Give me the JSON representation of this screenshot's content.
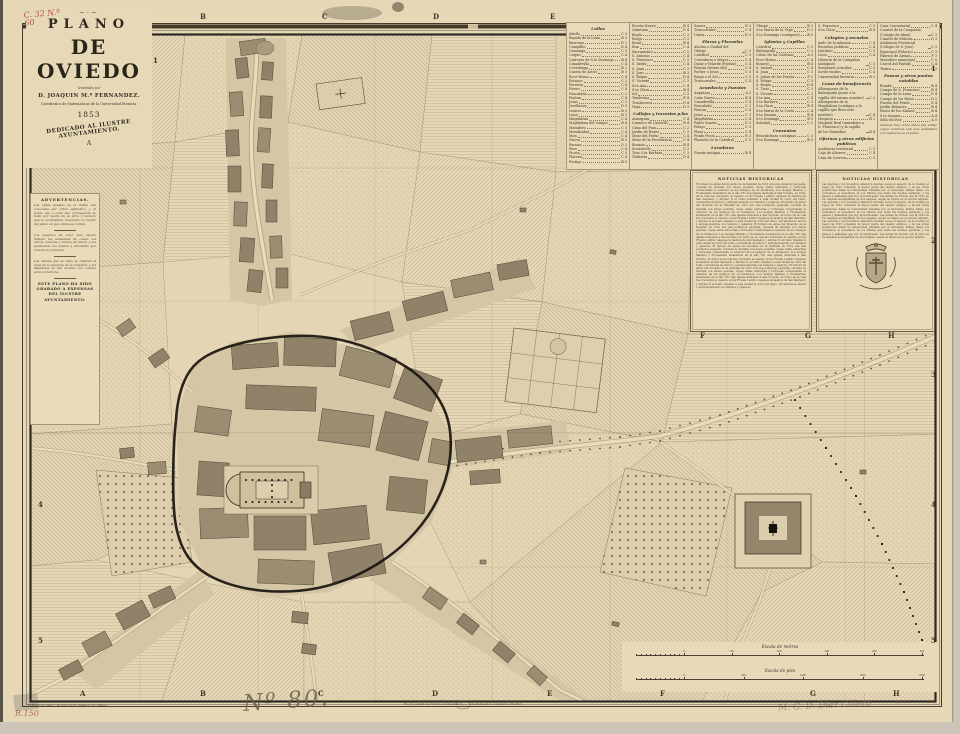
{
  "sheet": {
    "title_block": {
      "flourish": "~·~",
      "kicker": "PLANO",
      "title": "DE OVIEDO",
      "byline_small": "levantado por",
      "author": "D. JOAQUIN M.ª FERNANDEZ.",
      "author_role": "Catedratico de Matematicas de la Universidad literaria.",
      "year": "1853",
      "dedication": "DEDICADO AL ILUSTRE AYUNTAMIENTO.",
      "corner_mark": "A",
      "shelf_mark": "C. 32  N.º 60"
    },
    "grid": {
      "top_letters": [
        "B",
        "C",
        "D",
        "E"
      ],
      "mid_letters": [
        "F",
        "G",
        "H"
      ],
      "bottom_letters": [
        "A",
        "B",
        "C",
        "D",
        "E",
        "F",
        "G",
        "H"
      ],
      "left_numbers": [
        "1",
        "4",
        "5"
      ],
      "right_numbers": [
        "1",
        "2",
        "3",
        "4",
        "5"
      ]
    },
    "index": {
      "columns": [
        [
          {
            "h": "Calles"
          },
          [
            "Abello",
            "C 3"
          ],
          [
            "Bajada de la Luna",
            "B 3"
          ],
          [
            "Barreras",
            "D 2"
          ],
          [
            "Campillin",
            "D 4"
          ],
          [
            "Canoniga",
            "C 3"
          ],
          [
            "Carpio",
            "C 4"
          ],
          [
            "Carreras de S.to Domingo",
            "B 4"
          ],
          [
            "Cimadevilla",
            "C 4"
          ],
          [
            "Covadonga",
            "B 2"
          ],
          [
            "Cuesta de Arcos",
            "B 3"
          ],
          [
            "Ecce-Homo",
            "C 4"
          ],
          [
            "Estanco",
            "C 2"
          ],
          [
            "Ferreria",
            "C 4"
          ],
          [
            "Fierro",
            "C 4"
          ],
          [
            "Foncalada",
            "C 2"
          ],
          [
            "Fontan",
            "C 4"
          ],
          [
            "Jesus",
            "C 3"
          ],
          [
            "Jovellanos",
            "D 3"
          ],
          [
            "Leones",
            "B 3"
          ],
          [
            "Luna",
            "B 3"
          ],
          [
            "Magdalena",
            "C 4"
          ],
          [
            "Magdalena del Campo",
            "B 4"
          ],
          [
            "Matadero",
            "C 5"
          ],
          [
            "Mendizabal",
            "C 4"
          ],
          [
            "Mon",
            "C 4"
          ],
          [
            "Nueva",
            "B 3"
          ],
          [
            "Paraiso",
            "D 3"
          ],
          [
            "Peso",
            "C 4"
          ],
          [
            "Picota",
            "C 5"
          ],
          [
            "Plateria",
            "C 4"
          ],
          [
            "Postigo",
            "B 5"
          ]
        ],
        [
          [
            "Puerta Nueva",
            "B 4"
          ],
          [
            "Quintana",
            "D 4"
          ],
          [
            "Regla",
            "C 3"
          ],
          [
            "Riego",
            "C 3"
          ],
          [
            "Rosal",
            "B 4"
          ],
          [
            "Rua",
            "C 4"
          ],
          [
            "Sacramento",
            "C 5"
          ],
          [
            "S. Antonio",
            "C 4"
          ],
          [
            "S. Francisco",
            "C 3"
          ],
          [
            "S. Isidro",
            "C 4"
          ],
          [
            "S. Juan",
            "C 3"
          ],
          [
            "S. Jose",
            "B 3"
          ],
          [
            "S. Roque",
            "D 4"
          ],
          [
            "S. Vicente",
            "C 3"
          ],
          [
            "S.ta Ana",
            "C 4"
          ],
          [
            "S.ta Clara",
            "B 4"
          ],
          [
            "Sol",
            "C 3"
          ],
          [
            "Tenderina",
            "E 4"
          ],
          [
            "Traslacerca",
            "D 4"
          ],
          [
            "Vega",
            "D 3"
          ],
          {
            "h": "Callejas y travesias p.les"
          },
          [
            "Amargura",
            "C 4"
          ],
          [
            "Canseco de Castiello",
            "B 4"
          ],
          [
            "Cima del Prau",
            "C 2"
          ],
          [
            "Jardin de Reyes",
            "C 3"
          ],
          [
            "Mear del Forno",
            "C 4"
          ],
          [
            "Mear de la Providencia",
            "C 4"
          ],
          [
            "Rosario",
            "B 4"
          ],
          [
            "Socastiello",
            "C 3"
          ],
          [
            "Tras S.ta Barbara",
            "C 3"
          ],
          [
            "Vidrieria",
            "D 4"
          ]
        ],
        [
          [
            "Sames",
            "E 3"
          ],
          [
            "Trascorrales",
            "C 4"
          ],
          [
            "Union",
            "D 3"
          ],
          {
            "h": "Plazas y Plazuelas"
          },
          [
            "Alcoba o Ciudad del Obispo",
            "C 3"
          ],
          [
            "Catedral",
            "C 3"
          ],
          [
            "Correduria o Mayor",
            "C 4"
          ],
          [
            "Daoiz y Velarde (Fontan)",
            "C 4"
          ],
          [
            "Fontan (detras del)",
            "C 4"
          ],
          [
            "Porlier o Jesus",
            "C 3"
          ],
          [
            "Riego o el Sol",
            "C 3"
          ],
          [
            "Trascorrales",
            "C 4"
          ],
          {
            "h": "Acueducto y Fuentes"
          },
          [
            "Argañosa",
            "A 3"
          ],
          [
            "Caño Nuevo",
            "B 4"
          ],
          [
            "Cimadevilla",
            "C 4"
          ],
          [
            "Foncalada",
            "C 2"
          ],
          [
            "Fontan",
            "C 4"
          ],
          [
            "Jesus",
            "C 3"
          ],
          [
            "Magdalena",
            "C 4"
          ],
          [
            "Padre Suarez",
            "D 3"
          ],
          [
            "Pelayo",
            "C 3"
          ],
          [
            "Plaza",
            "C 4"
          ],
          [
            "Prado Picon",
            "E 3"
          ],
          [
            "Plazuela de la Catedral",
            "C 3"
          ],
          {
            "h": "Lavaderos"
          },
          [
            "Fuente antigua",
            "B 4"
          ]
        ],
        [
          [
            "Obispo",
            "B 3"
          ],
          [
            "S.ta Maria de la Vega",
            "D 2"
          ],
          [
            "S.to Domingo (contiguos)",
            "B 5"
          ],
          {
            "h": "Iglesias y Capillas"
          },
          [
            "Catedral",
            "C 3"
          ],
          [
            "Balesquida",
            "C 3"
          ],
          [
            "Cristo de las Cadenas",
            "A 5"
          ],
          [
            "Ecce-Homo",
            "C 4"
          ],
          [
            "Rosario",
            "B 4"
          ],
          [
            "S. Isidoro",
            "C 4"
          ],
          [
            "S. Juan",
            "C 3"
          ],
          [
            "S. Julian de los Prados",
            "F 2"
          ],
          [
            "S. Pelayo",
            "C 3"
          ],
          [
            "S. Roque",
            "D 4"
          ],
          [
            "S. Tirso",
            "C 3"
          ],
          [
            "S. Vicente",
            "C 3"
          ],
          [
            "S.ta Ana",
            "C 4"
          ],
          [
            "S.ta Barbara",
            "C 3"
          ],
          [
            "S.ta Clara",
            "B 4"
          ],
          [
            "S.ta Maria de la Corte",
            "C 4"
          ],
          [
            "S.ta Susana",
            "B 4"
          ],
          [
            "S.to Domingo",
            "B 5"
          ],
          [
            "Soledad",
            "C 2"
          ],
          {
            "h": "Conventos"
          },
          [
            "Benedictinas contiguas",
            "C 3"
          ],
          [
            "S.to Domingo",
            "B 5"
          ]
        ],
        [
          [
            "S. Francisco",
            "C 3"
          ],
          [
            "S.ta Clara",
            "B 4"
          ],
          {
            "h": "Colegios y escuelas"
          },
          [
            "Asilo de la infancia",
            "C 4"
          ],
          [
            "Escuelas publicas",
            "C 4"
          ],
          [
            "Instituto",
            "C 3"
          ],
          [
            "Liceo",
            "C 4"
          ],
          [
            "Libreria de la Compañia (antiguos)",
            "C 3"
          ],
          [
            "Seminario conciliar",
            "C 3"
          ],
          [
            "Sordo-mudos",
            "C 4"
          ],
          [
            "Universidad literaria",
            "B 3"
          ],
          {
            "h": "Casas de beneficencia"
          },
          [
            "Albergueria de la Balesquida (junto a la capilla del mismo nombre)",
            "C 3"
          ],
          [
            "Albergueria de la Magdalena (contigua a la capilla que lleva este nombre)",
            "C 4"
          ],
          [
            "Hospicio",
            "B 2"
          ],
          [
            "Hospital Real (inmediato a S. Francisco) y la capilla de los Remedios",
            "B 4"
          ],
          {
            "h": "Oficinas y otros edificios publicos"
          },
          [
            "Audiencia territorial",
            "C 3"
          ],
          [
            "Caja de Ahorros",
            "C 4"
          ],
          [
            "Casa de Correos",
            "C 3"
          ]
        ],
        [
          [
            "Casa Consistorial",
            "C 4"
          ],
          [
            "Cuartel de la Compañia (Colegio de idem)",
            "C 3"
          ],
          [
            "Cuartel de Milicias",
            "D 3"
          ],
          [
            "Audiencia Provincial (Colegio de S. Jose)",
            "C 3"
          ],
          [
            "Episcopal (Palacio)",
            "C 3"
          ],
          [
            "Fabrica de Armas",
            "F 3"
          ],
          [
            "Matadero municipal",
            "C 5"
          ],
          [
            "Carcel del Partido",
            "C 4"
          ],
          [
            "Teatro",
            "C 3"
          ],
          {
            "h": "Paseos y otros puntos notables"
          },
          [
            "Bombe",
            "B 4"
          ],
          [
            "Campo de S. Francisco",
            "B 4"
          ],
          [
            "Campo de la Lana",
            "D 4"
          ],
          [
            "Campo de los Patos",
            "D 2"
          ],
          [
            "Fuente del Prado",
            "E 4"
          ],
          [
            "Jardin Botanico",
            "B 4"
          ],
          [
            "Paseo de los Alamos",
            "B 4"
          ],
          [
            "S.ta Susana",
            "A 4"
          ],
          [
            "Silla del Rey",
            "A 5"
          ],
          {
            "t": "Ademas hay otros sitios del andar cuyos nombres van solo señalados con numeros en el plano."
          }
        ]
      ]
    },
    "notices": [
      {
        "title": "NOTICIAS HISTORICAS",
        "body": "El Oviedo de antes del incendio de la Navidad de 1521 era una poblacion pequeña, cercada de muralla con nueve puertas, cuyas calles estrechas y tortuosas conservaban el caracter de los tiempos de su fundacion. Los monjes Maximo y Fromestano levantaron en el año 761 una iglesia dedicada a San Vicente, en torno de la cual fue creciendo el caserio; el rey Fruela I edifico despues la basilica de San Salvador, y Alfonso II el Casto traslado a esta ciudad la corte del reino, cercandola de muros y enriqueciendola con templos y palacios. "
      },
      {
        "title": "NOTICIAS HISTORICAS",
        "body": "Las guerras y los incendios alteraron muchas veces el aspecto de la ciudad; el fuego de 1521 consumio la mayor parte del caserio antiguo, y de las obras posteriores datan la Universidad fundada por el Arzobispo Valdes Salas, los conventos, el acueducto de los Pilares que surte las fuentes publicas, y los paseos y alamedas que hoy la hermosean. Las armas de Oviedo son la Cruz de los Angeles acompañada de dos angeles, segun se figura en el escudo adjunto. "
      }
    ],
    "advertencia": {
      "title": "ADVERTENCIAS.",
      "p1": "Las calles puestas en el indice van colocadas por orden alfabetico, y el punto que a cada una corresponde se halla por medio de la letra y numero que la acompañan, buscando el cuadro del plano en que ambas se cortan.",
      "p2": "Los espacios de color mas oscuro indican las manzanas de casas; los claros, huertas y tierras de labor; y los punteados, los paseos y arboledas que rodean la poblacion.",
      "p3": "Las alturas que se citan se refieren al nivel de la plazuela de la Catedral, y las distancias se han medido con cadena sobre el terreno.",
      "footer": "ESTE PLANO HA SIDO GRABADO A EXPENSAS DEL ILUSTRE AYUNTAMIENTO."
    },
    "scales": [
      {
        "label": "Escala de metros",
        "sublabel": "ella",
        "ticks": [
          "0",
          "100",
          "200",
          "300",
          "400",
          "500"
        ]
      },
      {
        "label": "Escala de pies",
        "sublabel": "ella",
        "ticks": [
          "0",
          "500",
          "1000",
          "1500",
          "2000"
        ]
      }
    ],
    "footer": {
      "credit_left": "Grabado el plano y la letra por R. Alabern y E. Mabon.",
      "credit_center": "Es propiedad del Ilustre Ayuntamiento. — Litografia de la Academia, Madrid.",
      "credit_right": "J. Reinoso.",
      "handwritten_number": "Nº 80.",
      "pencil_shelf": "R.150",
      "pencil_signature": "M. G. D. Diez Calero"
    }
  }
}
